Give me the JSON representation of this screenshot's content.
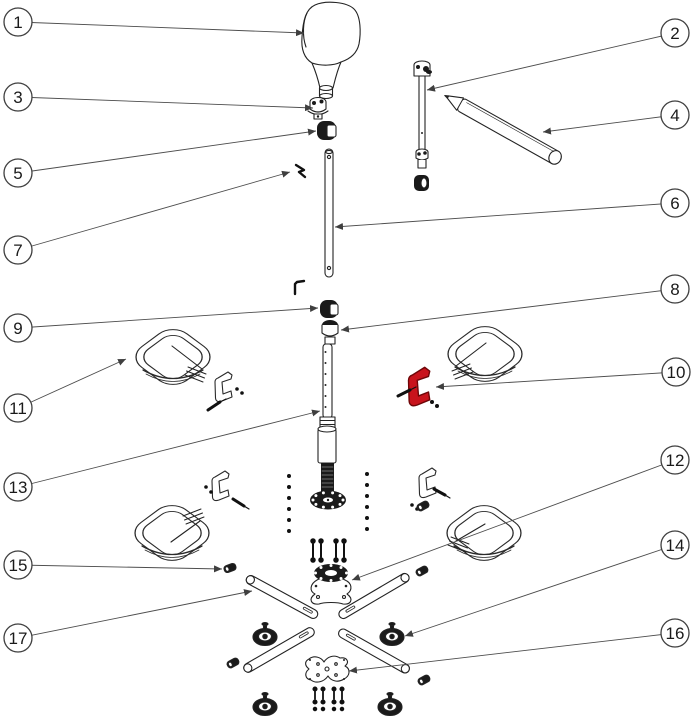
{
  "diagram": {
    "type": "exploded-parts-diagram",
    "background": "#ffffff",
    "colors": {
      "line": "#4d4d4d",
      "ink": "#232323",
      "balloon_stroke": "#3f3f3f",
      "highlight": "#c8131c",
      "highlight_stroke": "#6e0608"
    },
    "highlighted_callout": "10",
    "balloon_radius": 14,
    "callouts": [
      {
        "label": "1",
        "cx": 18,
        "cy": 22,
        "tx": 304,
        "ty": 33
      },
      {
        "label": "2",
        "cx": 675,
        "cy": 33,
        "tx": 427,
        "ty": 90
      },
      {
        "label": "3",
        "cx": 18,
        "cy": 97,
        "tx": 313,
        "ty": 108
      },
      {
        "label": "4",
        "cx": 675,
        "cy": 115,
        "tx": 543,
        "ty": 132
      },
      {
        "label": "5",
        "cx": 18,
        "cy": 173,
        "tx": 316,
        "ty": 131
      },
      {
        "label": "6",
        "cx": 675,
        "cy": 203,
        "tx": 335,
        "ty": 227
      },
      {
        "label": "7",
        "cx": 18,
        "cy": 250,
        "tx": 290,
        "ty": 172
      },
      {
        "label": "8",
        "cx": 675,
        "cy": 289,
        "tx": 341,
        "ty": 330
      },
      {
        "label": "9",
        "cx": 18,
        "cy": 328,
        "tx": 318,
        "ty": 308
      },
      {
        "label": "10",
        "cx": 676,
        "cy": 372,
        "tx": 436,
        "ty": 387
      },
      {
        "label": "11",
        "cx": 18,
        "cy": 408,
        "tx": 126,
        "ty": 359
      },
      {
        "label": "12",
        "cx": 675,
        "cy": 460,
        "tx": 352,
        "ty": 580
      },
      {
        "label": "13",
        "cx": 18,
        "cy": 487,
        "tx": 320,
        "ty": 411
      },
      {
        "label": "14",
        "cx": 675,
        "cy": 545,
        "tx": 405,
        "ty": 636
      },
      {
        "label": "15",
        "cx": 18,
        "cy": 565,
        "tx": 222,
        "ty": 569
      },
      {
        "label": "16",
        "cx": 675,
        "cy": 633,
        "tx": 349,
        "ty": 671
      },
      {
        "label": "17",
        "cx": 18,
        "cy": 638,
        "tx": 252,
        "ty": 591
      }
    ]
  }
}
